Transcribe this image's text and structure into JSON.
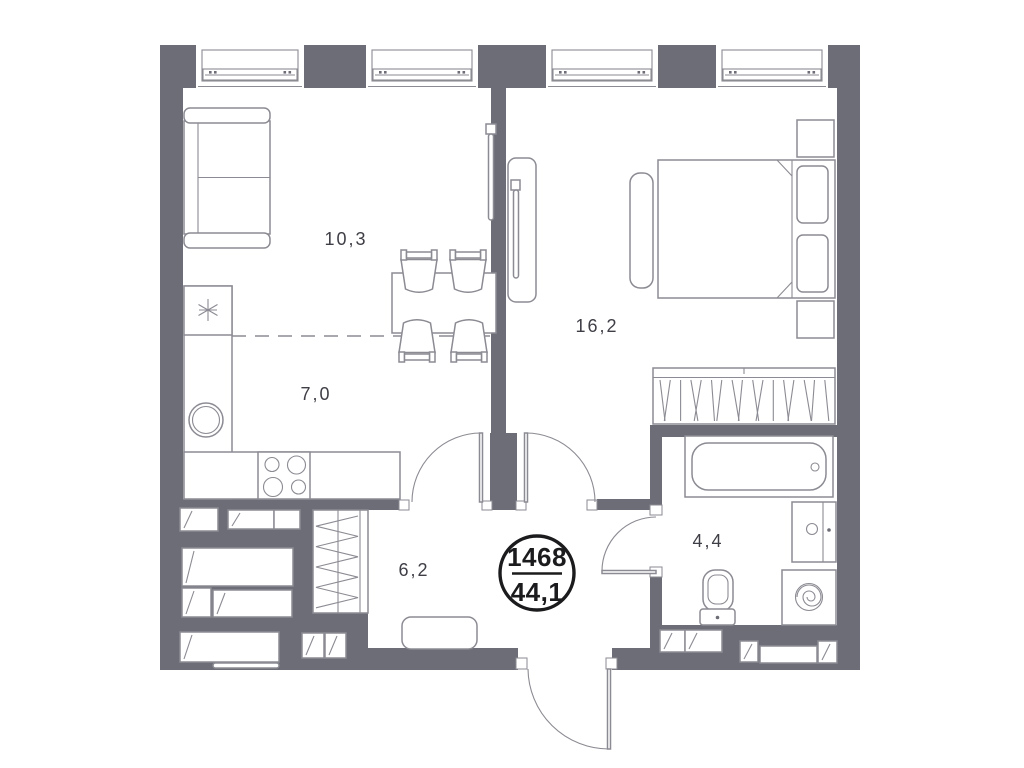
{
  "plan": {
    "badge": {
      "unit_number": "1468",
      "total_area": "44,1"
    },
    "rooms": {
      "living": {
        "area": "10,3"
      },
      "kitchen": {
        "area": "7,0"
      },
      "bedroom": {
        "area": "16,2"
      },
      "hallway": {
        "area": "6,2"
      },
      "bathroom": {
        "area": "4,4"
      }
    },
    "colors": {
      "wall": "#6d6d77",
      "furniture_line": "#8b8b93",
      "label_text": "#3e3e46",
      "badge": "#1b1b1d",
      "background": "#ffffff"
    }
  }
}
